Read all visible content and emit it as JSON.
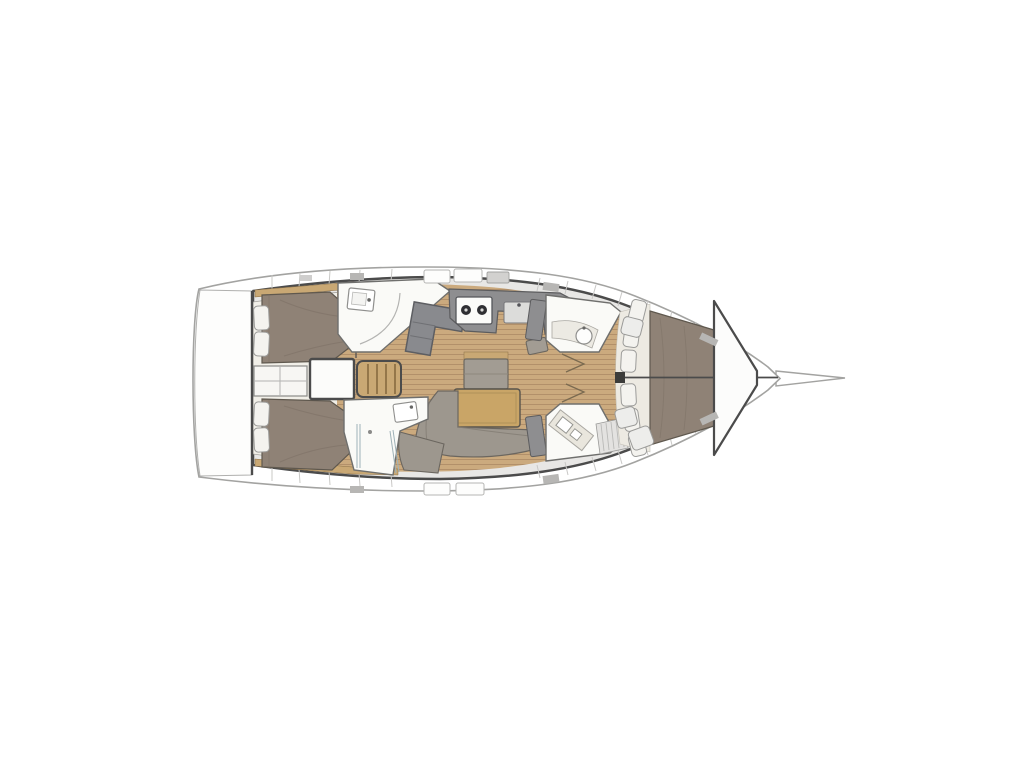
{
  "meta": {
    "title": "Sailing yacht interior layout plan, top-down view, bow pointing right"
  },
  "figure": {
    "type": "yacht-floorplan",
    "orientation": "bow-right",
    "regions": [
      "transom-swim-platform",
      "aft-cabin-port",
      "aft-cabin-starboard",
      "center-shelves",
      "engine-compartment",
      "companionway-steps",
      "aft-head-port",
      "nav-station",
      "galley",
      "salon-center-seat",
      "salon-table",
      "salon-settee",
      "aft-head-starboard",
      "forward-head-port",
      "forward-head-starboard",
      "mast-post",
      "v-berth-cabin",
      "anchor-locker",
      "bowsprit"
    ]
  },
  "palette": {
    "background": "#ffffff",
    "hull_outline": "#a3a3a1",
    "structure": "#4b4b4b",
    "deck": "#e8e7e5",
    "interior": "#f1efe8",
    "wood_floor": "#cbaa7e",
    "wood_line": "#b2906a",
    "wood_trim": "#c9a874",
    "bed": "#8f8276",
    "bed_seam": "#7c7064",
    "settee": "#9d978e",
    "settee_line": "#6b665f",
    "counter": "#8e8e90",
    "counter_dark": "#5c5c5e",
    "white_room": "#fafaf7",
    "pillow": "#f4f3ef",
    "table": "#c9a567",
    "glass": "#9fb2b8",
    "hatch_dark": "#b7b6b4",
    "hatch_light": "#fdfdfc",
    "divider": "#c9c8c6"
  }
}
